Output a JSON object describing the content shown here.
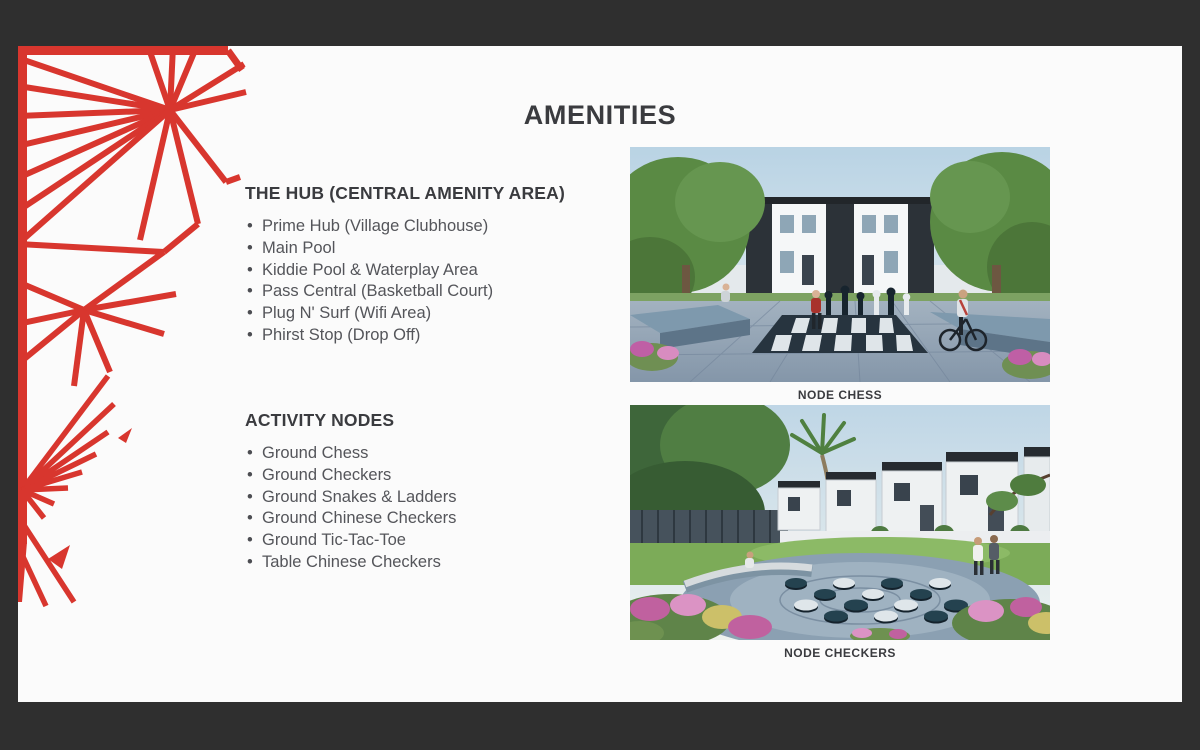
{
  "slide": {
    "title": "AMENITIES",
    "sections": [
      {
        "heading": "THE HUB (CENTRAL AMENITY AREA)",
        "items": [
          "Prime Hub (Village Clubhouse)",
          "Main Pool",
          "Kiddie Pool & Waterplay Area",
          "Pass Central (Basketball Court)",
          "Plug N' Surf (Wifi Area)",
          "Phirst Stop (Drop Off)"
        ]
      },
      {
        "heading": "ACTIVITY NODES",
        "items": [
          "Ground Chess",
          "Ground Checkers",
          "Ground Snakes & Ladders",
          "Ground Chinese Checkers",
          "Ground Tic-Tac-Toe",
          "Table Chinese Checkers"
        ]
      }
    ],
    "figures": [
      {
        "caption": "NODE CHESS"
      },
      {
        "caption": "NODE CHECKERS"
      }
    ],
    "colors": {
      "accent_red": "#d8362e",
      "frame": "#2f2f2f",
      "slide_bg": "#fbfbfb",
      "heading_text": "#3a3b3f",
      "body_text": "#54555a"
    }
  }
}
